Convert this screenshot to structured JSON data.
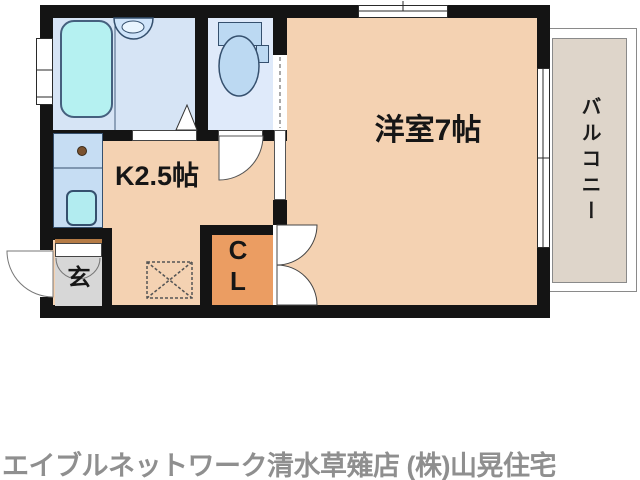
{
  "floor_plan": {
    "rooms": {
      "western_room": "洋室7帖",
      "kitchen": "K2.5帖",
      "closet": "C\nL",
      "entrance": "玄",
      "balcony": "バルコニー"
    },
    "colors": {
      "wall": "#141414",
      "room_floor": "#f4d2b2",
      "closet_floor": "#eb9d62",
      "entrance_floor": "#d7d7d7",
      "bathroom_floor": "#d6e4f5",
      "toilet_floor": "#dfeafa",
      "fixture_blue": "#bcd9f2",
      "tub_cyan": "#b5f1f1",
      "kitchen_counter": "#c6ddf3",
      "balcony_floor": "#ded5ca",
      "entrance_step": "#b57b45",
      "caption_gray": "#8f8f8f"
    }
  },
  "caption": "エイブルネットワーク清水草薙店 (株)山晃住宅"
}
